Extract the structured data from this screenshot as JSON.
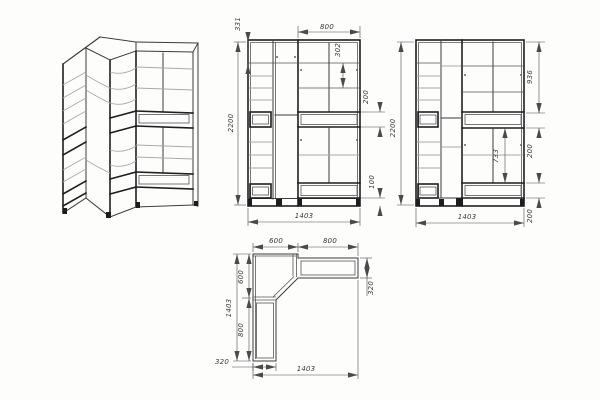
{
  "meta": {
    "drawing_type": "Corner wardrobe technical drawing",
    "units": "mm",
    "line_color": "#3b3b3b",
    "shelf_color": "#a9a9a9",
    "dimension_color": "#4a4a4a",
    "background": "#fdfdfc"
  },
  "views": {
    "isometric": {
      "label": "isometric wireframe projection"
    },
    "front": {
      "dims": {
        "top_shelf": "331",
        "height": "2200",
        "right_width": "800",
        "shelf_gap": "302",
        "drawer": "200",
        "plinth": "100",
        "width": "1403"
      }
    },
    "side": {
      "dims": {
        "height": "2200",
        "top_section": "936",
        "upper_drawer": "200",
        "shelf_span": "733",
        "lower_drawer": "200",
        "width": "1403"
      }
    },
    "plan": {
      "dims": {
        "corner_width": "600",
        "wing_width": "800",
        "corner_depth": "600",
        "depth_total": "1403",
        "left_wing_length": "800",
        "wing_depth_right": "320",
        "wing_depth_bottom": "320",
        "width_total": "1403"
      }
    }
  }
}
